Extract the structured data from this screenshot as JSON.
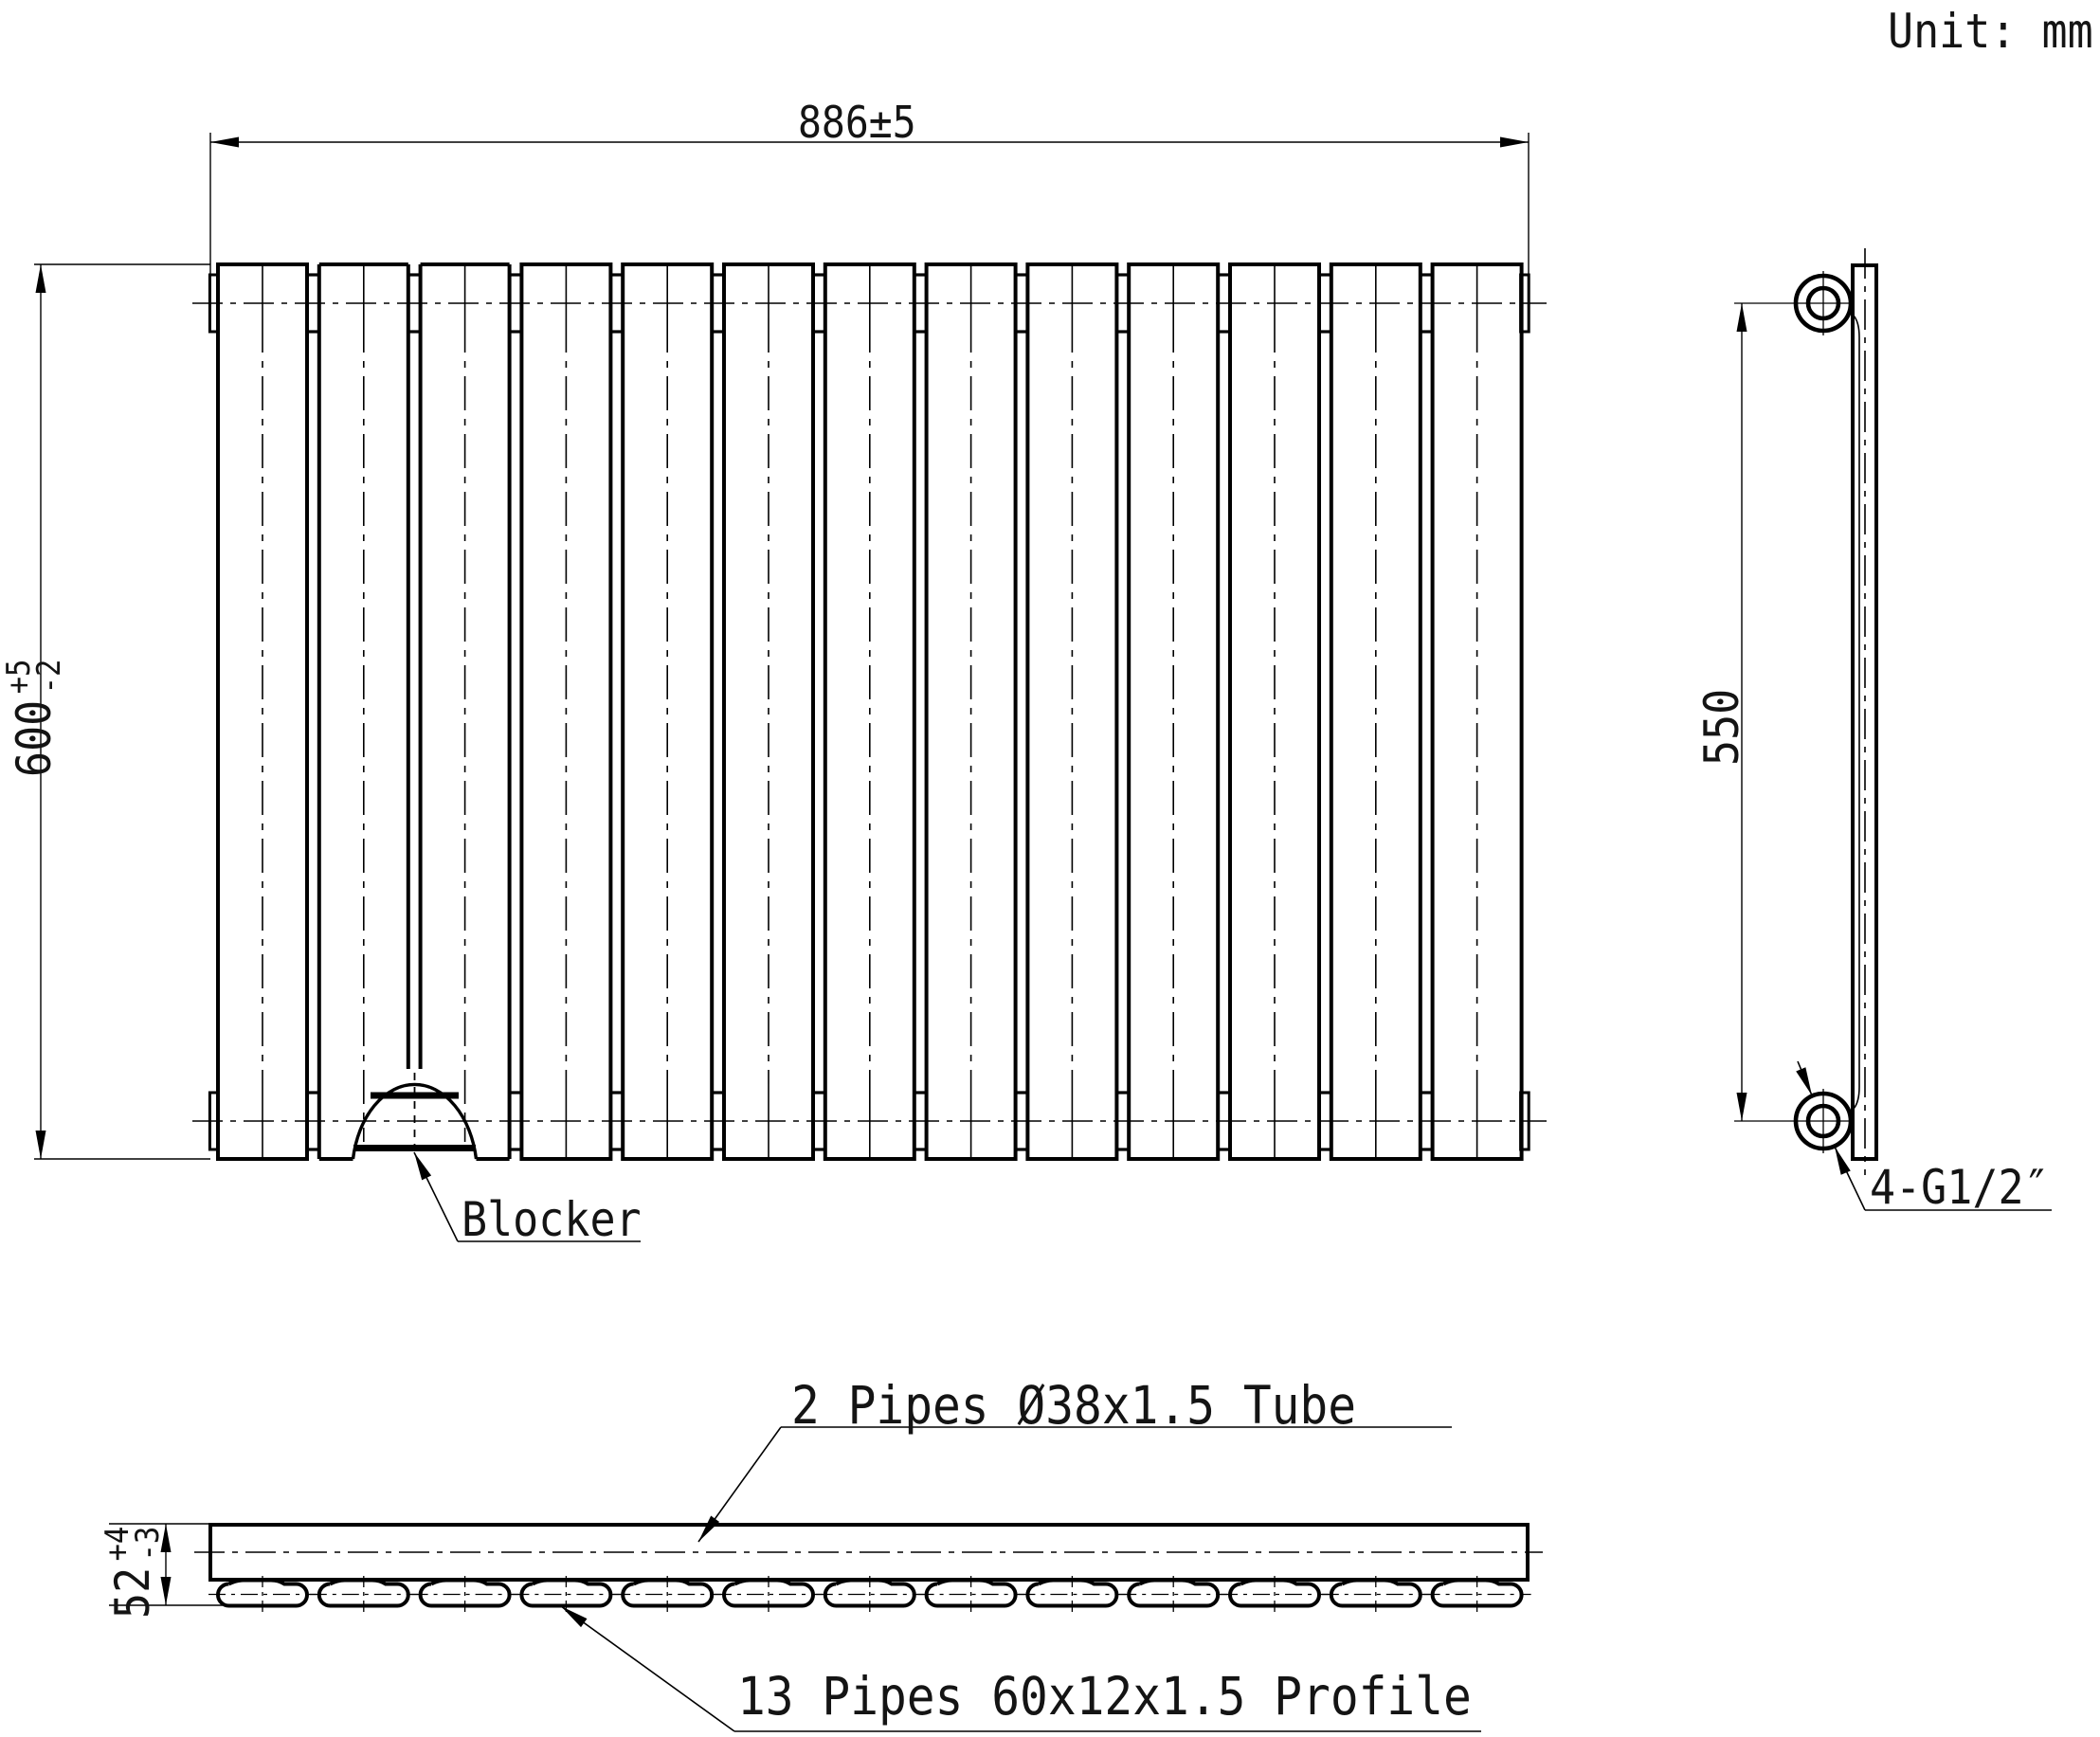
{
  "title": {
    "unit": "Unit: mm"
  },
  "front_view": {
    "panel_count": 13,
    "gap_count": 12,
    "blocker_gap_index": 1,
    "width_dim": "886±5",
    "height_dim": {
      "value": "600",
      "tol_top": "+5",
      "tol_bottom": "-2"
    },
    "blocker_label": "Blocker"
  },
  "side_view": {
    "center_dim": "550",
    "connection_label": "4-G1/2″"
  },
  "bottom_view": {
    "pipe_count": 13,
    "thickness_dim": {
      "value": "52",
      "tol_top": "+4",
      "tol_bottom": "-3"
    },
    "tube_label": "2 Pipes Ø38x1.5 Tube",
    "profile_label": "13 Pipes 60x12x1.5 Profile"
  },
  "colors": {
    "line": "#000000",
    "background": "#ffffff"
  }
}
